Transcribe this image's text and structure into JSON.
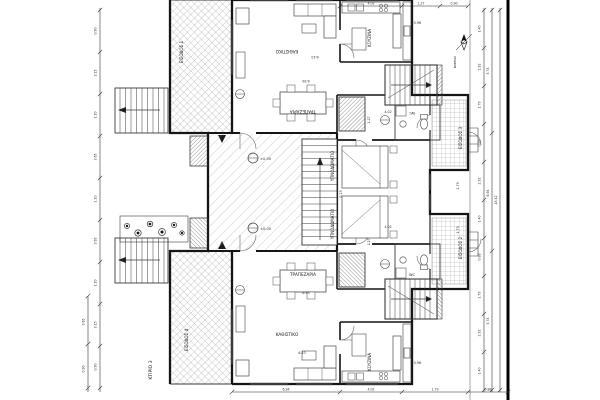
{
  "drawing": {
    "building_label": "ΚΤΙΡΙΟ 3",
    "north_label": "ΒΟΡΡΑΣ",
    "north_letter": "B"
  },
  "entrances": {
    "e1": "ΕΙΣΟΔΟΣ 1",
    "e2": "ΕΙΣΟΔΟΣ 2",
    "e3": "ΕΙΣΟΔΟΣ 3",
    "e4": "ΕΙΣΟΔΟΣ 4"
  },
  "unit_top": {
    "living": "ΚΑΘΙΣΤΙΚΟ",
    "dining": "ΤΡΑΠΕΖΑΡΙΑ",
    "kitchen": "ΚΟΥΖΙΝΑ",
    "bedroom": "ΥΠΝΟΔΩΜΑΤΙΟ",
    "wc": "WC",
    "level": "+0.96"
  },
  "unit_bottom": {
    "living": "ΚΑΘΙΣΤΙΚΟ",
    "dining": "ΤΡΑΠΕΖΑΡΙΑ",
    "kitchen": "ΚΟΥΖΙΝΑ",
    "bedroom": "ΥΠΝΟΔΩΜΑΤΙΟ",
    "wc": "WC",
    "level": "+0.96"
  },
  "levels": {
    "court": "±0.00"
  },
  "dims": {
    "left": [
      "0.90",
      "3.15",
      "1.20",
      "3.65",
      "1.10",
      "3.65",
      "1.20",
      "3.15",
      "0.90"
    ],
    "left2": [
      "3.65",
      "0.90"
    ],
    "right_inner": [
      "1.40",
      "2.92",
      "1.79",
      "0.88",
      "2.92",
      "1.40",
      "0.88",
      "1.79",
      "2.92",
      "1.40"
    ],
    "right_mid": [
      "5.74",
      "6.94",
      "5.74"
    ],
    "right_outer": [
      "18.42"
    ],
    "top": [
      "4.02",
      "1.27",
      "0.90"
    ],
    "bottom": [
      "6.94",
      "4.02",
      "1.79",
      "0.88"
    ],
    "plan_top": {
      "a": "6.43",
      "b": "6.94",
      "c": "1.27",
      "d": "1.79",
      "e": "4.02"
    },
    "plan_bottom": {
      "a": "6.43",
      "b": "6.94",
      "c": "1.27",
      "d": "1.79",
      "e": "4.02",
      "f": "0.25"
    }
  }
}
